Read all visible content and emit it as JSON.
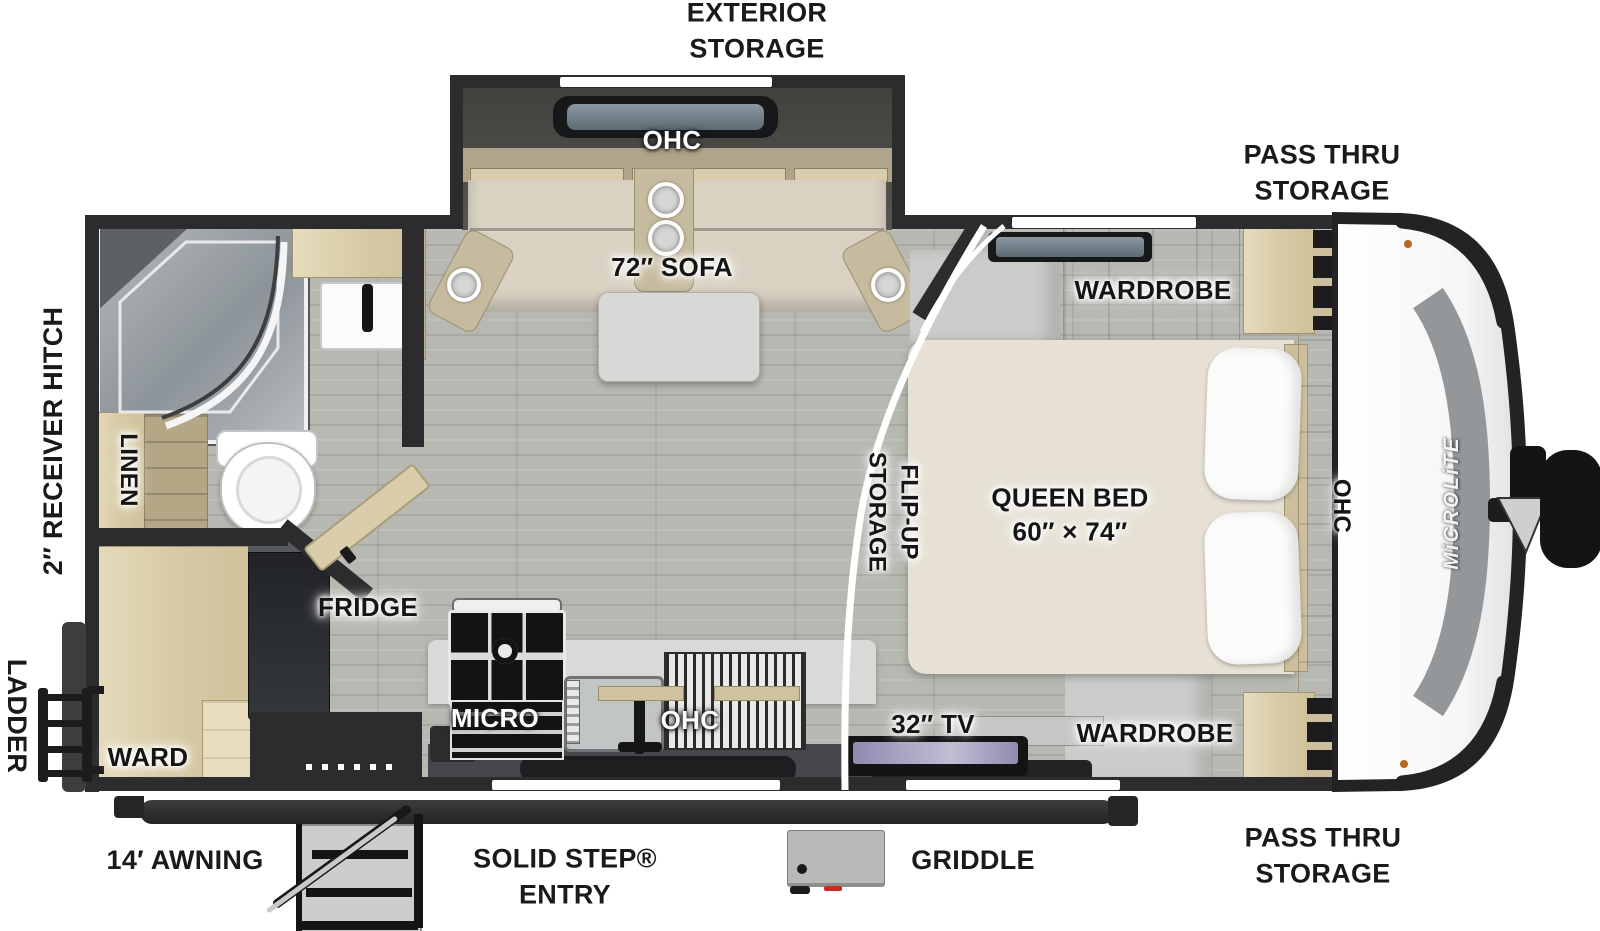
{
  "diagram": {
    "type": "travel-trailer-floorplan",
    "brand_logo": "MiCROLiTE"
  },
  "labels": {
    "exterior_storage_1": "EXTERIOR",
    "exterior_storage_2": "STORAGE",
    "pass_thru_1": "PASS THRU",
    "pass_thru_2": "STORAGE",
    "ohc": "OHC",
    "sofa": "72″ SOFA",
    "wardrobe": "WARDROBE",
    "queen_bed_1": "QUEEN BED",
    "queen_bed_2": "60″ × 74″",
    "flip_up_1": "FLIP-UP",
    "flip_up_2": "STORAGE",
    "tv": "32″ TV",
    "micro": "MICRO",
    "fridge": "FRIDGE",
    "linen": "LINEN",
    "ward": "WARD",
    "receiver_hitch": "2″ RECEIVER HITCH",
    "ladder": "LADDER",
    "awning": "14′ AWNING",
    "solid_step_1": "SOLID STEP®",
    "solid_step_2": "ENTRY",
    "griddle": "GRIDDLE",
    "logo": "MiCROLiTE"
  },
  "colors": {
    "wall": "#2c2c2e",
    "floor_wood": "#b6b8b1",
    "cabinet_wood": "#d9cda9",
    "upholstery": "#d9d2c3",
    "bed": "#e6e1d4",
    "label_text": "#151515",
    "front_cap": "#fdfdfd",
    "logo_band": "#94979a",
    "screen_glass": "#7e8b94"
  }
}
